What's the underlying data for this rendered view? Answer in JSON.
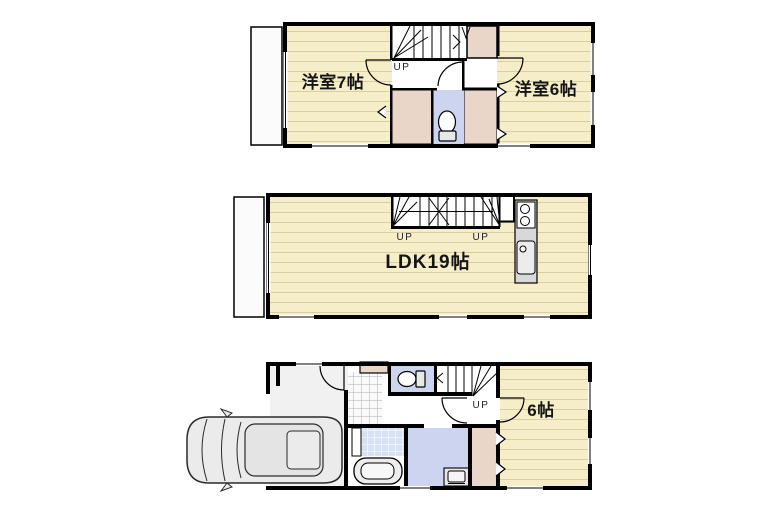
{
  "page": {
    "type": "real-estate-floor-plan",
    "background": "#FFFFFF",
    "floors_shown": 3
  },
  "palette": {
    "wall": "#000000",
    "room_floor": "#F6EEC9",
    "room_floor_line": "#D8CEA2",
    "closet": "#EAD6C8",
    "wet_area_blue": "#CDD4F0",
    "bath_tile": "#D9E2F5",
    "garage": "#F1F1F1",
    "kitchen_counter": "#D8D8D8",
    "balcony": "#FBFBFB"
  },
  "floor_top": {
    "room_left_label": "洋室7帖",
    "room_right_label": "洋室6帖",
    "stairs_label": "UP"
  },
  "floor_middle": {
    "room_label": "LDK19帖",
    "stairs_label_left": "UP",
    "stairs_label_right": "UP"
  },
  "floor_bottom": {
    "room_label": "6帖",
    "stairs_label": "UP"
  },
  "icons": {
    "toilet": "toilet-icon",
    "bathtub": "bathtub-icon",
    "washbasin": "washbasin-icon",
    "stove": "stove-icon",
    "kitchen_sink": "kitchen-sink-icon",
    "car": "car-icon",
    "stairs": "stairs-icon"
  }
}
